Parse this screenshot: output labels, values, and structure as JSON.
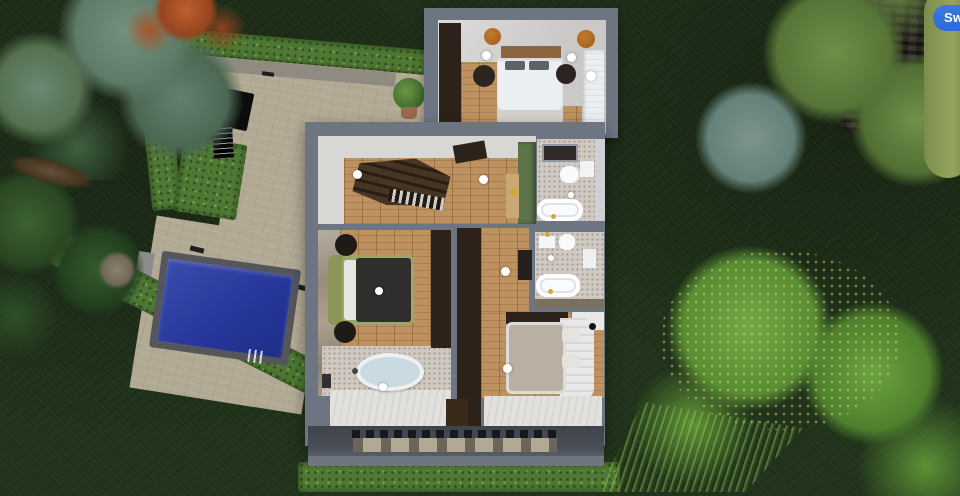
{
  "ui": {
    "switch_button": "Swi"
  },
  "colors": {
    "grass": "#20331a",
    "hedge": "#4e7833",
    "patio": "#b2a994",
    "pool_water": "#27379b",
    "pool_coping": "#55565c",
    "wall_gray": "#6d7582",
    "balcony": "#4a4f58",
    "wood_floor": "#bd9260",
    "stairs": "#34281c",
    "green_wall": "#5d7549",
    "bath_floor": "#cfc9c2",
    "carpet": "#d6d3cf",
    "bed_white": "#eceff1",
    "duvet_dark": "#2f2e2c",
    "bed_green": "#9aa768",
    "duvet_beige": "#b9b0a3",
    "wardrobe_dark": "#2c2219",
    "accent_blue": "#2e6bd6",
    "tree_green": "#6ca33f",
    "pine_gray": "#74907e",
    "tree_orange": "#b25c2e",
    "pine_dark": "#355a2d"
  }
}
